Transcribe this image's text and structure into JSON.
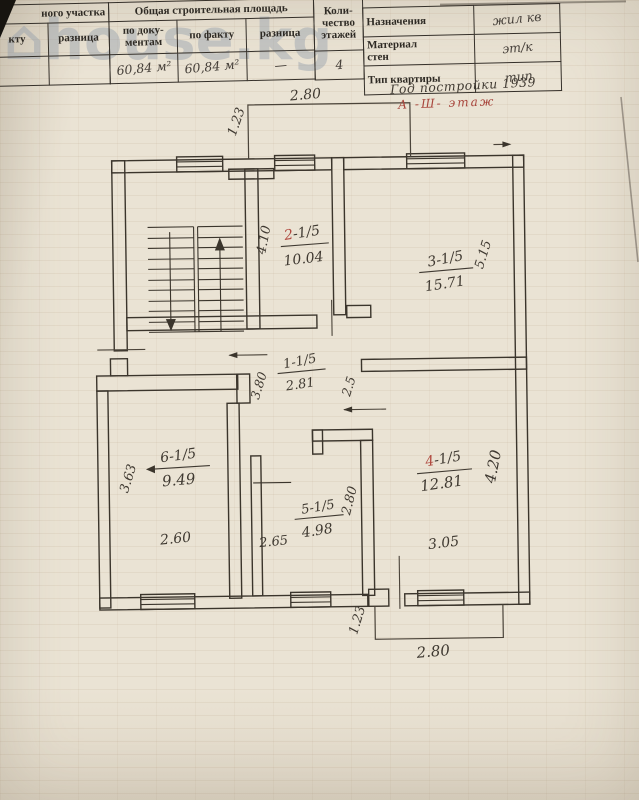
{
  "watermark": {
    "icon": "⌂",
    "text": "house.kg"
  },
  "table": {
    "land": {
      "group_header": "ного участка",
      "columns": [
        "кту",
        "разница"
      ],
      "values": [
        "",
        ""
      ]
    },
    "build_area": {
      "group_header": "Общая строительная площадь",
      "columns": [
        "по доку-\nментам",
        "по факту",
        "разница"
      ],
      "values": [
        "60,84 м²",
        "60,84 м²",
        "—"
      ]
    },
    "floors": {
      "header": "Коли-\nчество\nэтажей",
      "value": "4"
    },
    "info": {
      "rows": [
        {
          "label": "Назначения",
          "value": "жил кв"
        },
        {
          "label": "Материал\nстен",
          "value": "эт/к"
        },
        {
          "label": "Тип квартиры",
          "value": "тип"
        }
      ]
    },
    "notes": {
      "year": "Год постройки 1939",
      "floor_note": "А -Ш- этаж"
    }
  },
  "plan": {
    "rooms": [
      {
        "name": "room-2",
        "num_accent": "2",
        "num_rest": "-1/5",
        "area": "10.04"
      },
      {
        "name": "room-3",
        "num": "3-1/5",
        "area": "15.71"
      },
      {
        "name": "corridor-1",
        "num": "1-1/5",
        "area": "2.81"
      },
      {
        "name": "room-6",
        "num": "6-1/5",
        "area": "9.49"
      },
      {
        "name": "room-5",
        "num": "5-1/5",
        "area": "4.98"
      },
      {
        "name": "room-4",
        "num_accent": "4",
        "num_rest": "-1/5",
        "area": "12.81"
      }
    ],
    "dims": {
      "top_balcony_w": "2.80",
      "top_balcony_d": "1.23",
      "room2_h": "4.10",
      "room3_h": "5.15",
      "corridor_w": "3.80",
      "corridor_d": "2.5",
      "room6_h": "3.63",
      "room6_w": "2.60",
      "room5_w": "2.65",
      "room5_h": "2.80",
      "room4_h": "4.20",
      "room4_w": "3.05",
      "bot_balcony_d": "1.23",
      "bot_balcony_w": "2.80"
    }
  }
}
